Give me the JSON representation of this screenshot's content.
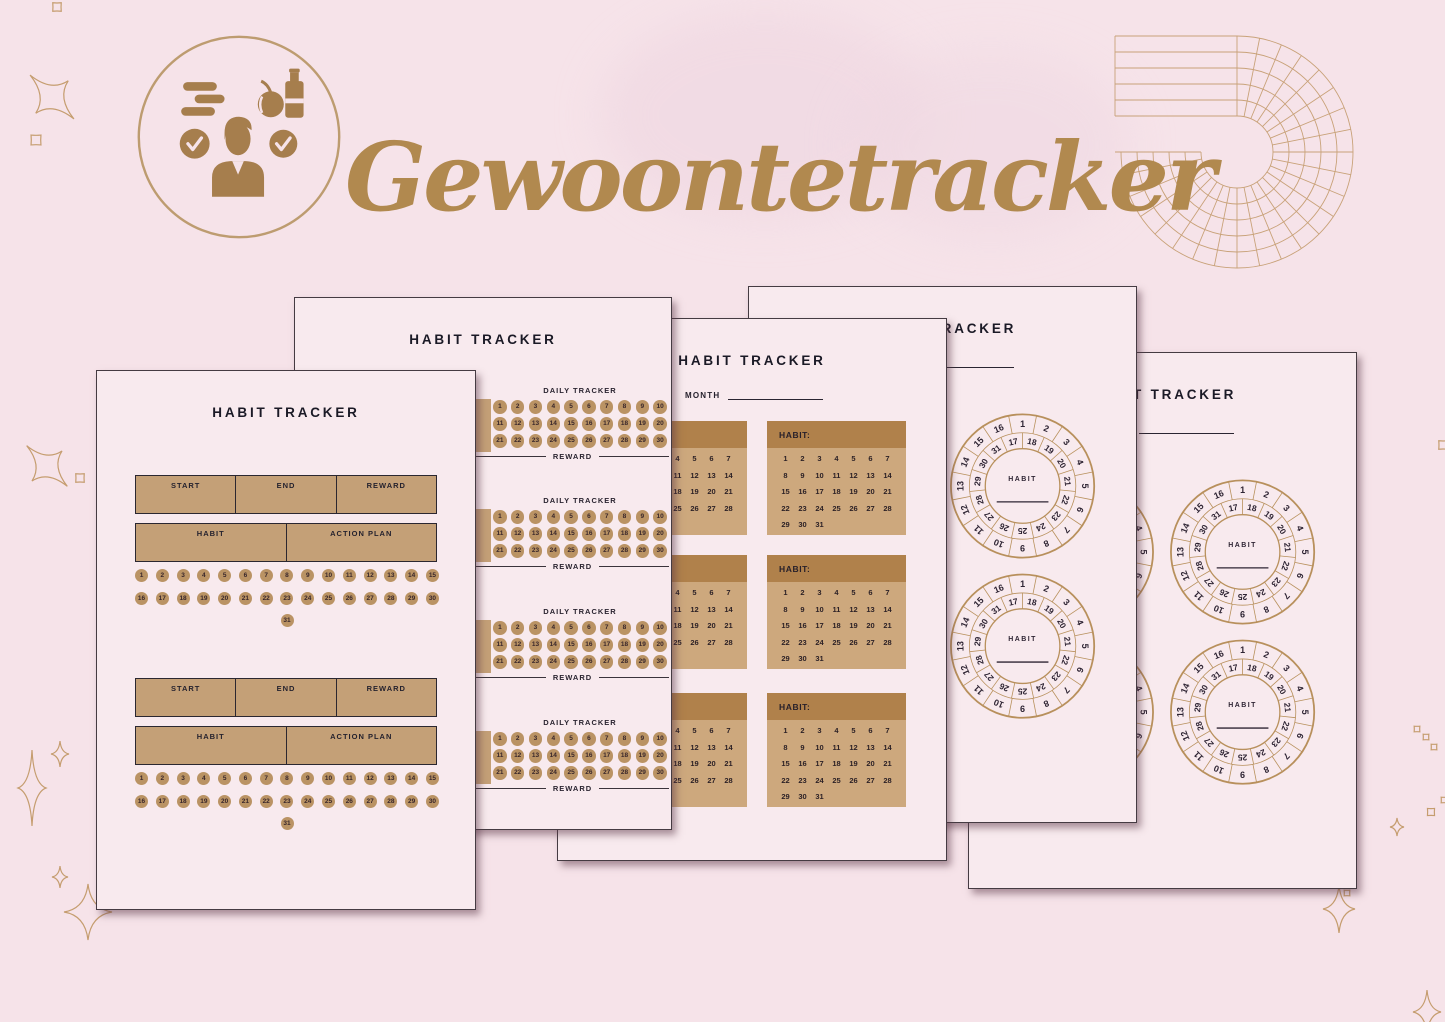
{
  "brand": {
    "title": "Gewoontetracker"
  },
  "colors": {
    "background": "#f6e3e9",
    "page": "#f8eaee",
    "gold_title": "#b1894f",
    "tan_box": "#c4a077",
    "tan_header": "#b0814b",
    "tan_body": "#cda87d",
    "day_circle": "#ba9364",
    "ink": "#1b1a26",
    "wheel_stroke": "#b8905c",
    "logo_brown": "#a67e4d"
  },
  "page_boxes": {
    "title": "HABIT TRACKER",
    "start": "START",
    "end": "END",
    "reward": "REWARD",
    "habit": "HABIT",
    "action_plan": "ACTION PLAN",
    "blocks": 2,
    "days": [
      1,
      2,
      3,
      4,
      5,
      6,
      7,
      8,
      9,
      10,
      11,
      12,
      13,
      14,
      15,
      16,
      17,
      18,
      19,
      20,
      21,
      22,
      23,
      24,
      25,
      26,
      27,
      28,
      29,
      30,
      31
    ]
  },
  "page_daily": {
    "title": "HABIT TRACKER",
    "section_label": "DAILY TRACKER",
    "reward_label": "REWARD",
    "sections": 4,
    "days": [
      1,
      2,
      3,
      4,
      5,
      6,
      7,
      8,
      9,
      10,
      11,
      12,
      13,
      14,
      15,
      16,
      17,
      18,
      19,
      20,
      21,
      22,
      23,
      24,
      25,
      26,
      27,
      28,
      29,
      30
    ]
  },
  "page_month": {
    "title": "HABIT TRACKER",
    "month_label": "MONTH",
    "habit_label": "HABIT:",
    "cards": 6,
    "days": [
      1,
      2,
      3,
      4,
      5,
      6,
      7,
      8,
      9,
      10,
      11,
      12,
      13,
      14,
      15,
      16,
      17,
      18,
      19,
      20,
      21,
      22,
      23,
      24,
      25,
      26,
      27,
      28,
      29,
      30,
      31
    ]
  },
  "page_wheel": {
    "title": "HABIT TRACKER",
    "month_label": "MONTH",
    "habit_label": "HABIT",
    "wheels_per_page": 4,
    "outer": [
      1,
      2,
      3,
      4,
      5,
      6,
      7,
      8,
      9,
      10,
      11,
      12,
      13,
      14,
      15,
      16
    ],
    "inner": [
      17,
      18,
      19,
      20,
      21,
      22,
      23,
      24,
      25,
      26,
      27,
      28,
      29,
      30,
      31
    ]
  }
}
